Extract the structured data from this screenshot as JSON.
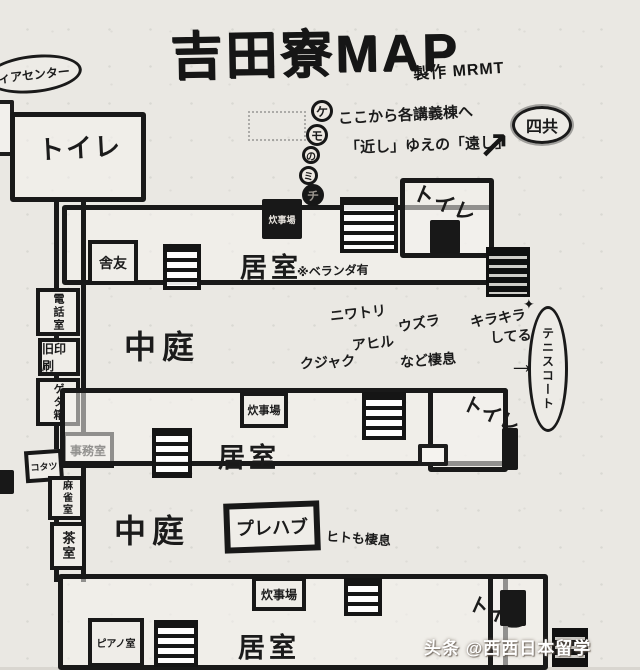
{
  "title": {
    "text": "吉田寮MAP",
    "credit": "製作 MRMT"
  },
  "stamps": {
    "media_center": "ィアセンター",
    "yonkyo": "四共",
    "arrow_ne": "↗"
  },
  "trail": {
    "circles": [
      "ケ",
      "モ",
      "の",
      "ミ",
      "チ"
    ],
    "note1": "ここから各講義棟へ",
    "note2": "「近し」ゆえの「遠し」"
  },
  "wing1": {
    "toilet_nw": "トイレ",
    "kitchen": "炊事場",
    "toilet_ne": "トイレ",
    "shayu": "舎友",
    "room": "居室",
    "veranda": "※ベランダ有"
  },
  "court1": {
    "label": "中庭",
    "animals": [
      "ニワトリ",
      "ウズラ",
      "アヒル",
      "クジャク"
    ],
    "inhabit": "など棲息"
  },
  "west": {
    "phone": "電話室",
    "old_print": "旧印刷",
    "geta": "ゲタ箱",
    "kotatsu": "コタツ",
    "office": "事務室",
    "mahjong": "麻雀室",
    "tea": "茶室"
  },
  "tennis": {
    "sparkle": "キラキラ",
    "sparkle2": "してる",
    "star": "✦",
    "arrow": "→",
    "court": "テニスコート"
  },
  "wing2": {
    "kitchen": "炊事場",
    "toilet": "トイレ",
    "room": "居室"
  },
  "court2": {
    "label": "中庭",
    "prefab": "プレハブ",
    "inhabit": "ヒトも棲息"
  },
  "wing3": {
    "kitchen": "炊事場",
    "room": "居室",
    "toilet": "トイレ",
    "piano": "ピアノ室"
  },
  "watermark": {
    "logo": "头条",
    "handle": "@西西日本留学"
  }
}
